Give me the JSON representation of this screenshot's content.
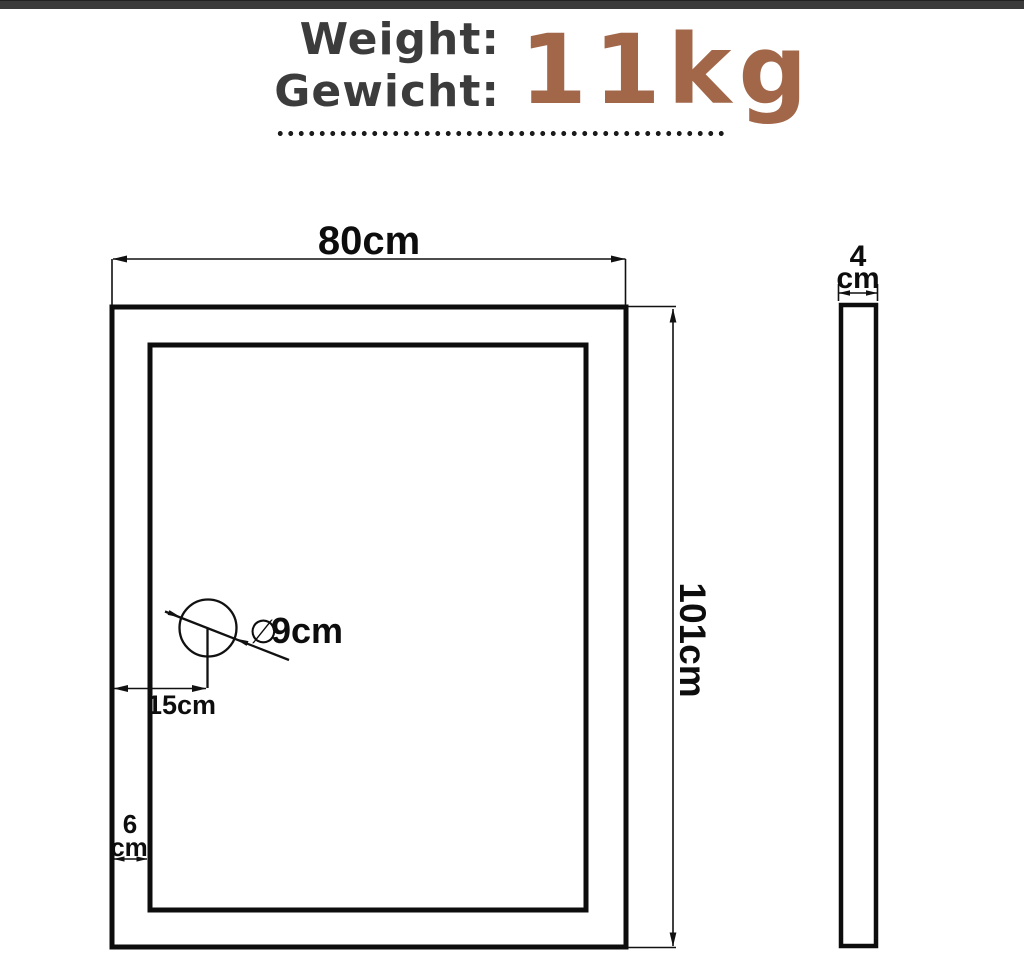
{
  "page": {
    "background": "#ffffff",
    "top_bar_color": "#3b3b3b"
  },
  "header": {
    "weight_label_en": "Weight:",
    "weight_label_de": "Gewicht:",
    "weight_value": "11kg",
    "label_color": "#3c3c3c",
    "value_color": "#a26749"
  },
  "diagram": {
    "front_view": {
      "width_label": "80cm",
      "height_label": "101cm",
      "frame_width_value": "6",
      "frame_width_unit": "cm",
      "drain_offset_label": "15cm",
      "drain_diameter_symbol": "∅",
      "drain_diameter_value": "9cm"
    },
    "side_view": {
      "thickness_value": "4",
      "thickness_unit": "cm"
    }
  }
}
